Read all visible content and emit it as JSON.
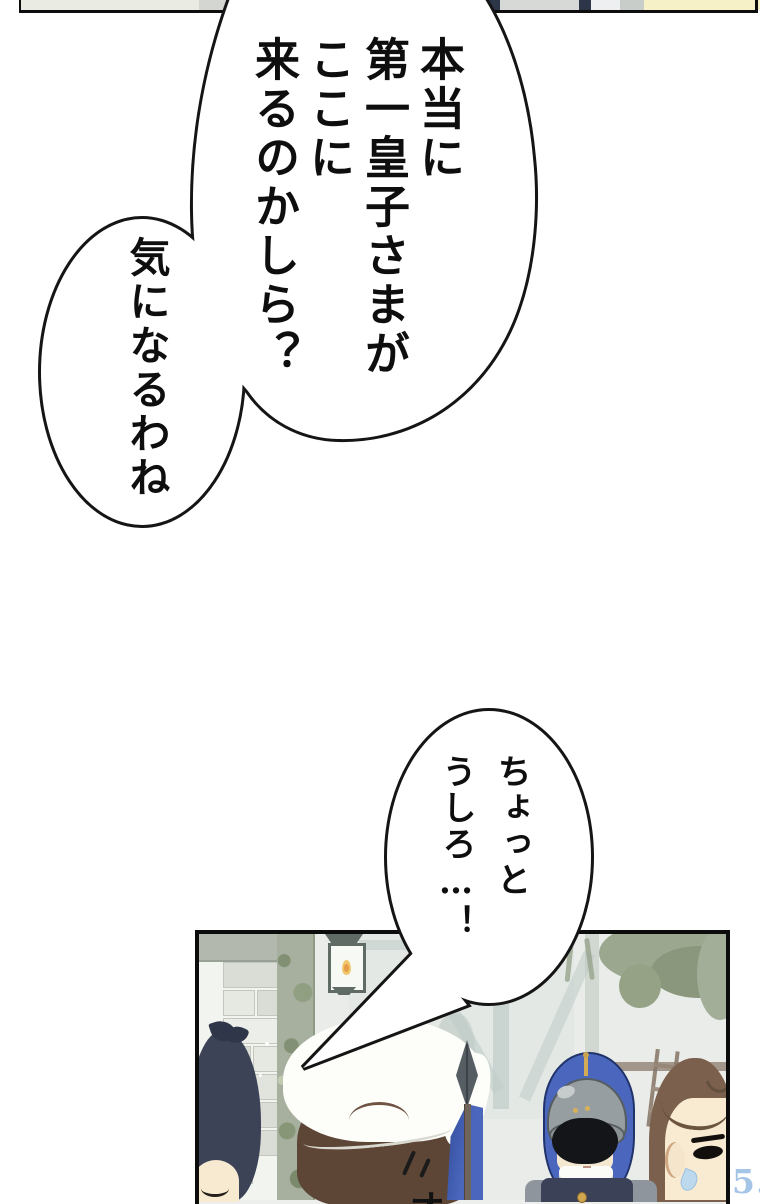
{
  "speech": {
    "bubble_main": {
      "columns": [
        "本当に",
        "第一皇子さまが",
        "ここに",
        "来るのかしら？"
      ]
    },
    "bubble_sub": {
      "text": "気になるわね"
    },
    "bubble_warning": {
      "columns": [
        "ちょっと",
        "うしろ…！"
      ]
    }
  },
  "sfx": {
    "text": "オ"
  },
  "watermark": {
    "tagline": "のない楽しみ",
    "logo_text": "漫神",
    "url": "KMANSIN91-95.COM",
    "color": "#6ba0d8"
  },
  "colors": {
    "panel_border": "#0c0c0c",
    "guard_blue": "#4a67bd",
    "pale_yellow": "#f6f1c6",
    "navy": "#2d3648",
    "moss_green": "#a7b09e"
  }
}
